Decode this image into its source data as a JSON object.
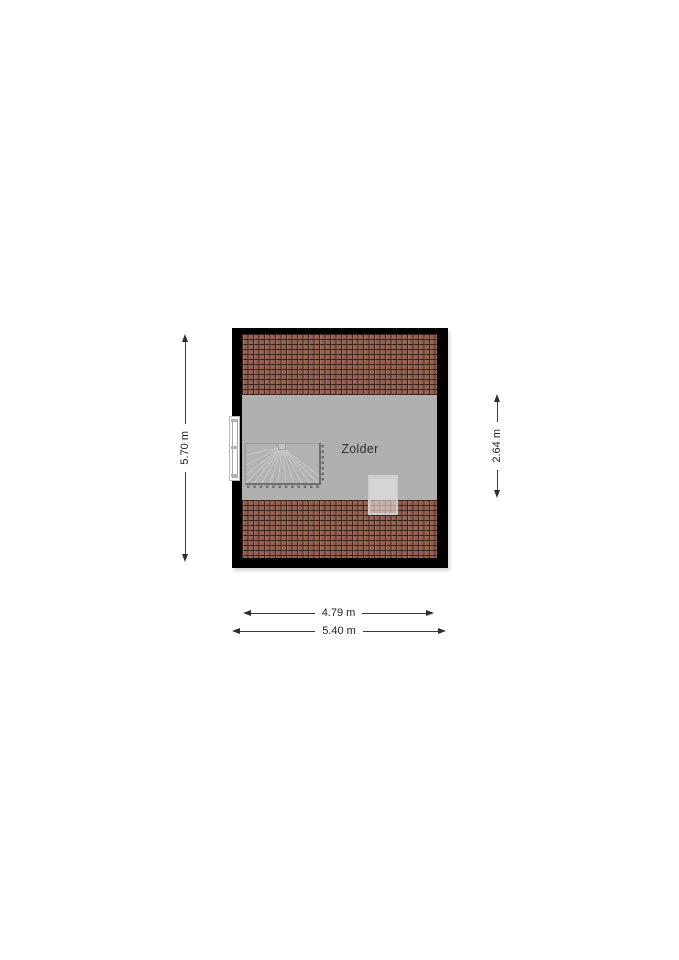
{
  "floorplan": {
    "room_label": "Zolder",
    "colors": {
      "background": "#ffffff",
      "wall": "#000000",
      "floor": "#b0b0b0",
      "roof_tiles": "#91604e",
      "roof_tile_joint": "#2c1610",
      "stairs_fill": "#b2b2b2",
      "stairs_tread_line": "#c8c8c8",
      "stairs_railing": "#6f6f6f",
      "window_fill": "#ffffff",
      "skylight_frame": "#cdcdcd",
      "dimension_line": "#2e2e2e"
    }
  },
  "dimensions": {
    "left_total_height": "5.70 m",
    "right_floor_height": "2.64 m",
    "bottom_inner_width": "4.79 m",
    "bottom_total_width": "5.40 m"
  }
}
